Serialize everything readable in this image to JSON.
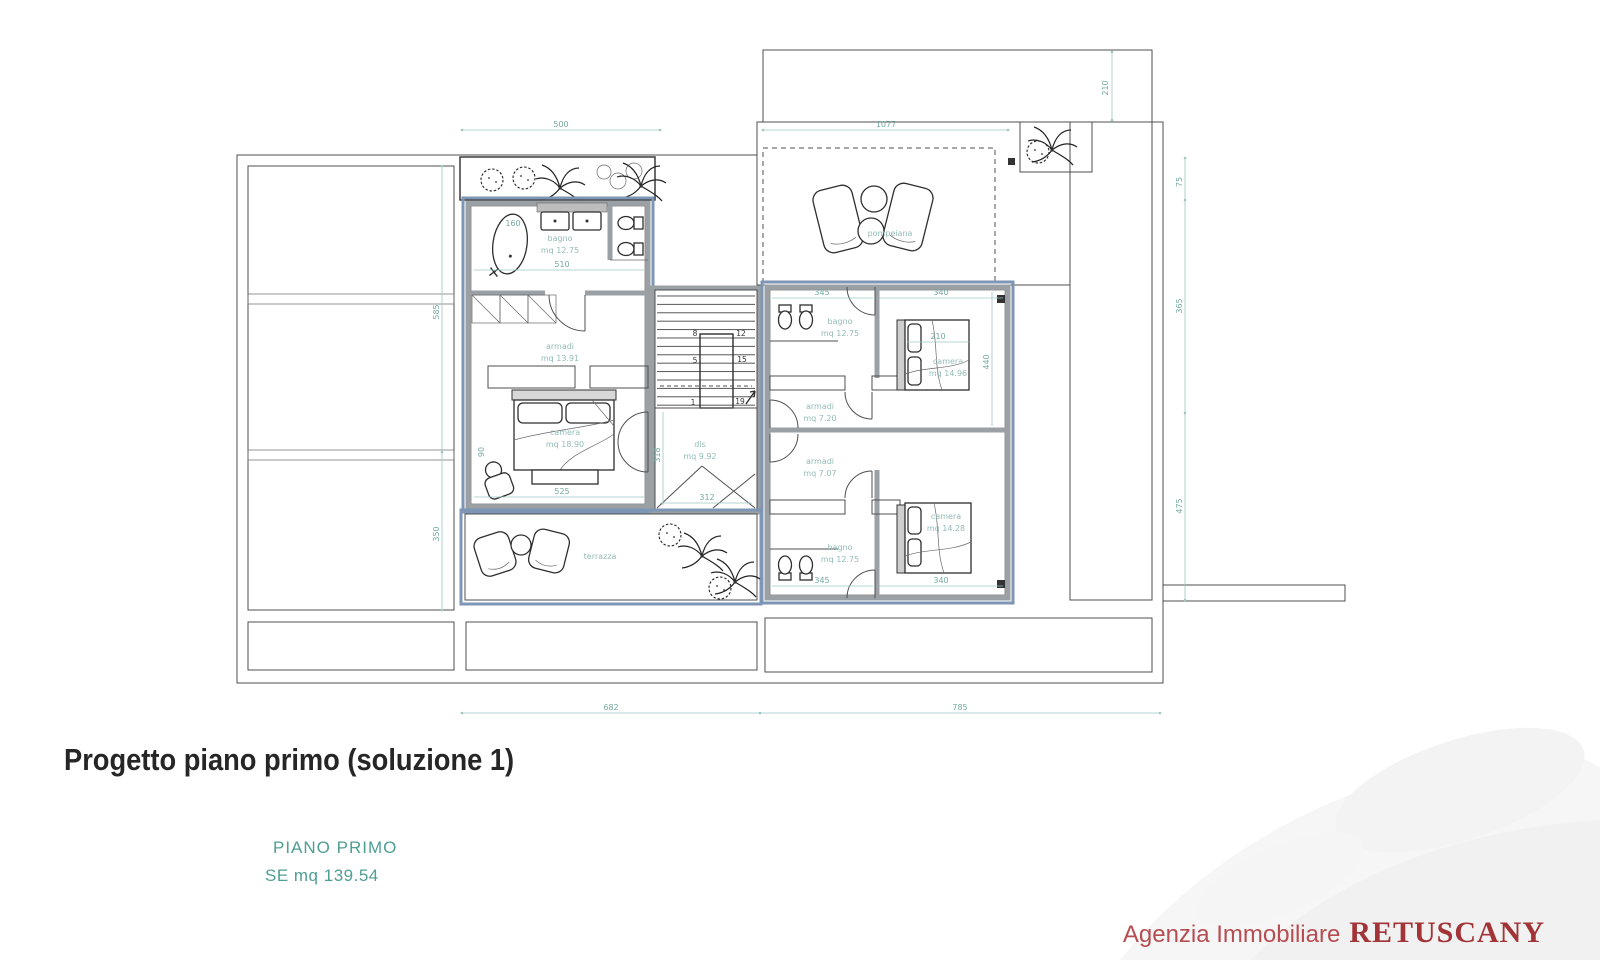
{
  "title": "Progetto piano primo (soluzione 1)",
  "floor_label": "PIANO PRIMO",
  "floor_area": "SE mq 139.54",
  "agency": {
    "prefix": "Agenzia Immobiliare",
    "name": "RETUSCANY"
  },
  "colors": {
    "accent_blue": "#7e96b5",
    "wall_gray": "#9aa0a4",
    "dimension_teal": "#74aaa2",
    "title_dark": "#262626",
    "agency_red": "#a23337"
  },
  "rooms": {
    "bagno_a": {
      "name": "bagno",
      "area": "mq 12.75"
    },
    "armadi_a": {
      "name": "armadi",
      "area": "mq 13.91"
    },
    "camera_a": {
      "name": "camera",
      "area": "mq 18.90"
    },
    "terrazza": {
      "name": "terrazza"
    },
    "dis": {
      "name": "dis",
      "area": "mq 9.92"
    },
    "pompeiana": {
      "name": "pompeiana"
    },
    "bagno_b": {
      "name": "bagno",
      "area": "mq 12.75"
    },
    "camera_b": {
      "name": "camera",
      "area": "mq 14.96"
    },
    "armadi_b": {
      "name": "armadi",
      "area": "mq 7.20"
    },
    "armadi_c": {
      "name": "armadi",
      "area": "mq 7.07"
    },
    "bagno_c": {
      "name": "bagno",
      "area": "mq 12.75"
    },
    "camera_c": {
      "name": "camera",
      "area": "mq 14.28"
    }
  },
  "stairs": {
    "s1": "1",
    "s5": "5",
    "s8": "8",
    "s12": "12",
    "s15": "15",
    "s19": "19"
  },
  "dims": {
    "top_500": "500",
    "top_1077": "1077",
    "strip_210": "210",
    "right_75": "75",
    "right_365": "365",
    "right_475": "475",
    "left_585": "585",
    "left_350": "350",
    "bottom_682": "682",
    "bottom_785": "785",
    "bagno_510": "510",
    "tub_160": "160",
    "camera_525": "525",
    "camera_90": "90",
    "dis_318": "318",
    "dis_312": "312",
    "b345_top": "345",
    "b340_top": "340",
    "bed_210": "210",
    "b440": "440",
    "b345_bot": "345",
    "b340_bot": "340"
  }
}
